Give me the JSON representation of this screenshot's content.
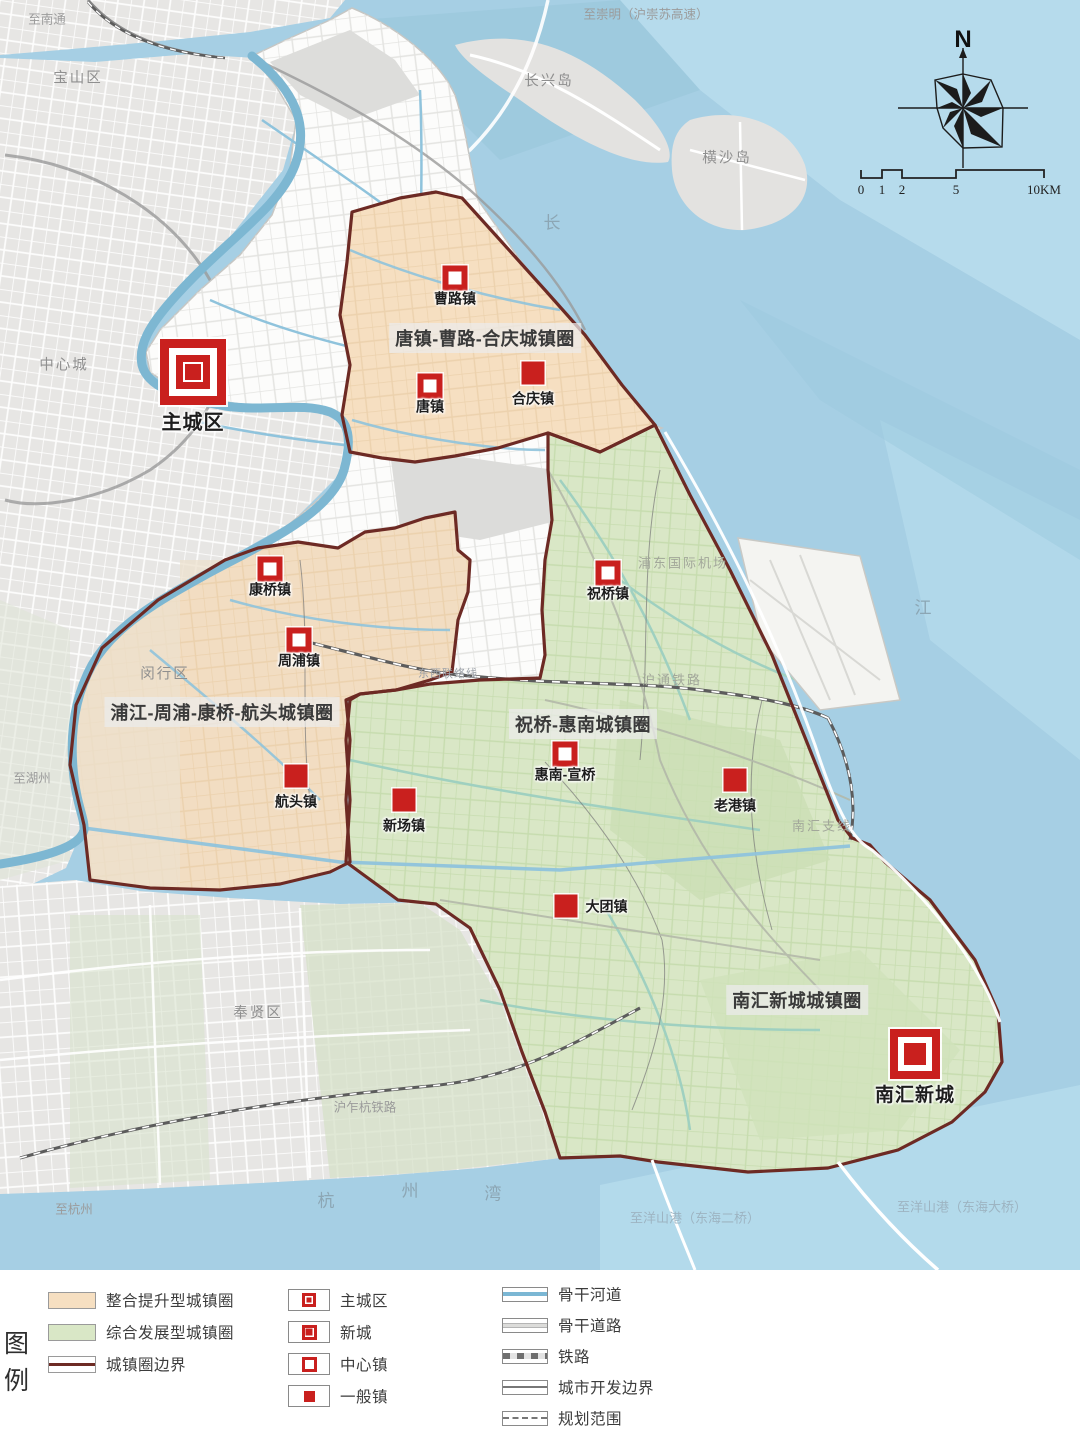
{
  "map": {
    "compass_n": "N",
    "scale_ticks": [
      "0",
      "1",
      "2",
      "5",
      "10KM"
    ],
    "circle_titles": [
      {
        "text": "唐镇-曹路-合庆城镇圈",
        "x": 485,
        "y": 338
      },
      {
        "text": "浦江-周浦-康桥-航头城镇圈",
        "x": 222,
        "y": 712
      },
      {
        "text": "祝桥-惠南城镇圈",
        "x": 583,
        "y": 724
      },
      {
        "text": "南汇新城城镇圈",
        "x": 797,
        "y": 1000
      }
    ],
    "markers": [
      {
        "type": "main-city",
        "label": "主城区",
        "x": 193,
        "y": 372,
        "label_side": "bottom"
      },
      {
        "type": "center-town",
        "label": "曹路镇",
        "x": 455,
        "y": 278,
        "label_side": "bottom"
      },
      {
        "type": "center-town",
        "label": "唐镇",
        "x": 430,
        "y": 386,
        "label_side": "bottom"
      },
      {
        "type": "general-town",
        "label": "合庆镇",
        "x": 533,
        "y": 373,
        "label_side": "bottom"
      },
      {
        "type": "center-town",
        "label": "康桥镇",
        "x": 270,
        "y": 569,
        "label_side": "bottom"
      },
      {
        "type": "center-town",
        "label": "周浦镇",
        "x": 299,
        "y": 640,
        "label_side": "bottom"
      },
      {
        "type": "general-town",
        "label": "航头镇",
        "x": 296,
        "y": 776,
        "label_side": "bottom"
      },
      {
        "type": "general-town",
        "label": "新场镇",
        "x": 404,
        "y": 800,
        "label_side": "bottom"
      },
      {
        "type": "center-town",
        "label": "祝桥镇",
        "x": 608,
        "y": 573,
        "label_side": "bottom"
      },
      {
        "type": "center-town",
        "label": "惠南-宣桥",
        "x": 565,
        "y": 754,
        "label_side": "bottom"
      },
      {
        "type": "general-town",
        "label": "老港镇",
        "x": 735,
        "y": 780,
        "label_side": "bottom"
      },
      {
        "type": "general-town",
        "label": "大团镇",
        "x": 566,
        "y": 906,
        "label_side": "right"
      },
      {
        "type": "new-city",
        "label": "南汇新城",
        "x": 915,
        "y": 1054,
        "label_side": "bottom"
      }
    ],
    "geo_labels": [
      {
        "text": "至南通",
        "x": 47,
        "y": 18,
        "kind": "road"
      },
      {
        "text": "宝山区",
        "x": 78,
        "y": 77,
        "kind": "district"
      },
      {
        "text": "至崇明（沪崇苏高速）",
        "x": 646,
        "y": 13,
        "kind": "road"
      },
      {
        "text": "长兴岛",
        "x": 549,
        "y": 80,
        "kind": "district"
      },
      {
        "text": "横沙岛",
        "x": 727,
        "y": 157,
        "kind": "district"
      },
      {
        "text": "中心城",
        "x": 64,
        "y": 364,
        "kind": "district"
      },
      {
        "text": "闵行区",
        "x": 165,
        "y": 673,
        "kind": "district"
      },
      {
        "text": "至湖州",
        "x": 32,
        "y": 777,
        "kind": "road"
      },
      {
        "text": "奉贤区",
        "x": 258,
        "y": 1012,
        "kind": "district"
      },
      {
        "text": "沪乍杭铁路",
        "x": 365,
        "y": 1106,
        "kind": "road"
      },
      {
        "text": "至杭州",
        "x": 74,
        "y": 1208,
        "kind": "road"
      },
      {
        "text": "浦东国际机场",
        "x": 683,
        "y": 562,
        "kind": "faint"
      },
      {
        "text": "沪通铁路",
        "x": 672,
        "y": 679,
        "kind": "faint"
      },
      {
        "text": "东西联络线",
        "x": 448,
        "y": 673,
        "kind": "tiny"
      },
      {
        "text": "南汇支线",
        "x": 822,
        "y": 825,
        "kind": "faint"
      },
      {
        "text": "长",
        "x": 553,
        "y": 221,
        "kind": "water"
      },
      {
        "text": "江",
        "x": 924,
        "y": 606,
        "kind": "water"
      },
      {
        "text": "杭",
        "x": 327,
        "y": 1199,
        "kind": "water"
      },
      {
        "text": "州",
        "x": 411,
        "y": 1189,
        "kind": "water"
      },
      {
        "text": "湾",
        "x": 494,
        "y": 1192,
        "kind": "water"
      },
      {
        "text": "至洋山港（东海二桥）",
        "x": 695,
        "y": 1217,
        "kind": "water-road"
      },
      {
        "text": "至洋山港（东海大桥）",
        "x": 962,
        "y": 1206,
        "kind": "water-road"
      }
    ]
  },
  "legend": {
    "title": "图例",
    "title_chars": [
      "图",
      "例"
    ],
    "zones": [
      {
        "label": "整合提升型城镇圈"
      },
      {
        "label": "综合发展型城镇圈"
      },
      {
        "label": "城镇圈边界"
      }
    ],
    "places": [
      {
        "label": "主城区"
      },
      {
        "label": "新城"
      },
      {
        "label": "中心镇"
      },
      {
        "label": "一般镇"
      }
    ],
    "lines": [
      {
        "label": "骨干河道"
      },
      {
        "label": "骨干道路"
      },
      {
        "label": "铁路"
      },
      {
        "label": "城市开发边界"
      },
      {
        "label": "规划范围"
      }
    ]
  },
  "colors": {
    "marker_red": "#c9201e",
    "zone_orange": "#f6dfc1",
    "zone_green": "#d9e7c6",
    "circle_boundary": "#6d2a24",
    "water": "#a6cfe4",
    "land_gray": "#e7e6e4",
    "pudong_white": "#fcfcfb"
  }
}
